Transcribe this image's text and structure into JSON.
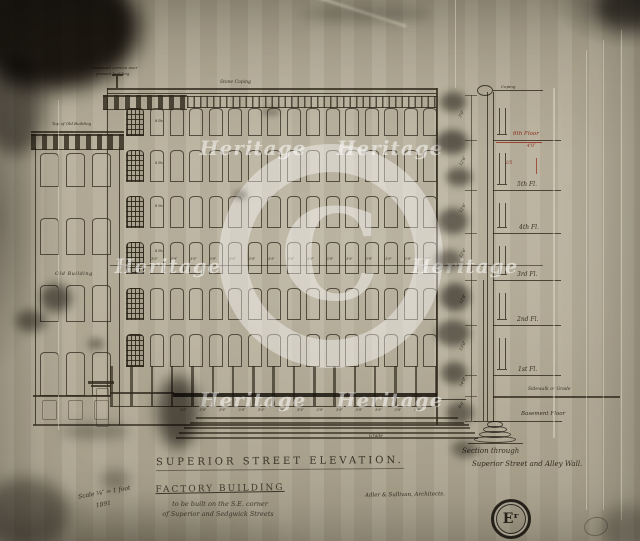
{
  "watermark": {
    "text": "Heritage",
    "symbol": "C"
  },
  "annotations": {
    "top_note_line1": "Proposed cornice over",
    "top_note_line2": "present building",
    "stone_coping": "Stone Coping",
    "top_of_old_building": "Top of Old Building",
    "old_building": "Old Building",
    "grade": "Grade",
    "window_note": "8 lts",
    "bay_dim": "3'9″"
  },
  "section": {
    "coping": "Coping",
    "floor6_red": "6th Floor",
    "red_dim": "4'0″",
    "red_frac": "2/5",
    "floor5": "5th Fl.",
    "floor4": "4th Fl.",
    "floor3": "3rd Fl.",
    "floor2": "2nd Fl.",
    "floor1": "1st Fl.",
    "sidewalk": "Sidewalk or Grade",
    "basement": "Basement Floor",
    "dims": [
      "3'0″",
      "12'6″",
      "12'6″",
      "12'6″",
      "12'8″",
      "13'0″",
      "14'0″",
      "9'0″"
    ],
    "title_line1": "Section through",
    "title_line2": "Superior Street and Alley Wall."
  },
  "titles": {
    "elevation": "Superior Street Elevation.",
    "project_line1": "Factory Building",
    "project_line2": "to be built on the S.E. corner",
    "project_line3": "of Superior and Sedgwick Streets",
    "architect": "Adler & Sullivan, Architects.",
    "scale_line1": "Scale ⅛″ = 1 foot",
    "scale_line2": "1891"
  },
  "stamp": {
    "text": "Eʳ"
  }
}
